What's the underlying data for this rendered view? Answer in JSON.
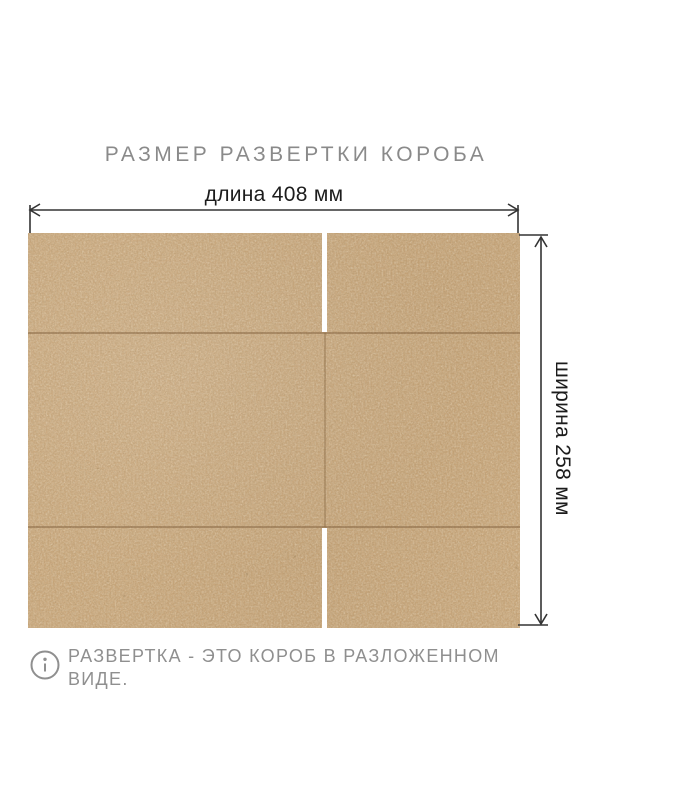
{
  "title": "РАЗМЕР РАЗВЕРТКИ КОРОБА",
  "dimensions": {
    "length": {
      "label": "длина 408 мм",
      "value_mm": 408
    },
    "width": {
      "label": "ширина 258 мм",
      "value_mm": 258
    }
  },
  "note": {
    "icon": "info-icon",
    "text": "РАЗВЕРТКА - ЭТО КОРОБ В РАЗЛОЖЕННОМ ВИДЕ."
  },
  "colors": {
    "background": "#ffffff",
    "cardboard": "#cba87c",
    "fold_line": "#9c7a4e",
    "slot": "#ffffff",
    "dimension_line": "#333333",
    "title_text": "#8a8a8a",
    "dimension_text": "#1c1c1c",
    "note_text": "#8f8f8f"
  }
}
